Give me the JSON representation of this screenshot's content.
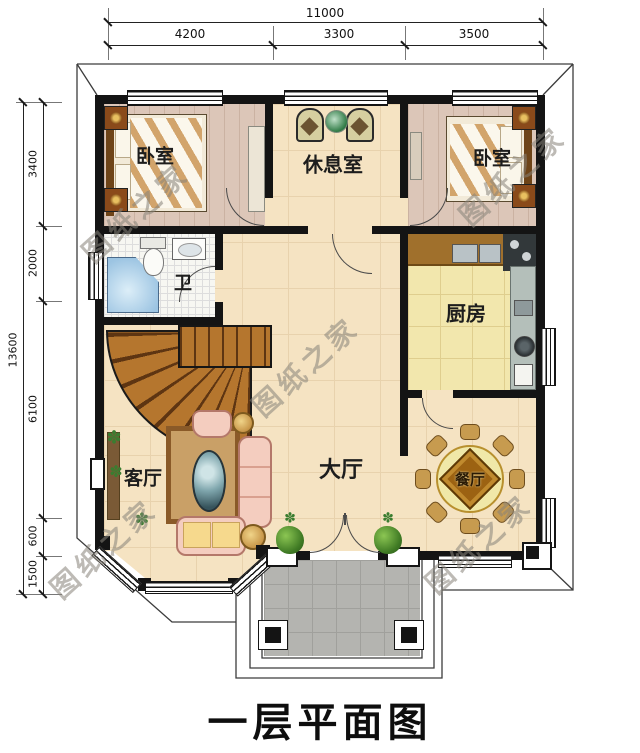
{
  "title": "一层平面图",
  "watermark": "图纸之家",
  "dimensions": {
    "top": {
      "total": "11000",
      "segments": [
        "4200",
        "3300",
        "3500"
      ]
    },
    "left": {
      "total": "13600",
      "segments": [
        "3400",
        "2000",
        "6100",
        "600",
        "1500"
      ]
    }
  },
  "rooms": {
    "bedroom_left": "卧室",
    "lounge": "休息室",
    "bedroom_right": "卧室",
    "bathroom": "卫",
    "kitchen": "厨房",
    "living_room": "客厅",
    "hall": "大厅",
    "dining_room": "餐厅"
  },
  "colors": {
    "wall": "#141414",
    "floor_main": "#f5e3c2",
    "floor_bedroom": "#dcc6b8",
    "floor_kitchen": "#f2e7ad",
    "floor_porch": "#b4b4b0",
    "stair_wood": "#b5762e",
    "watermark": "#88837a"
  }
}
